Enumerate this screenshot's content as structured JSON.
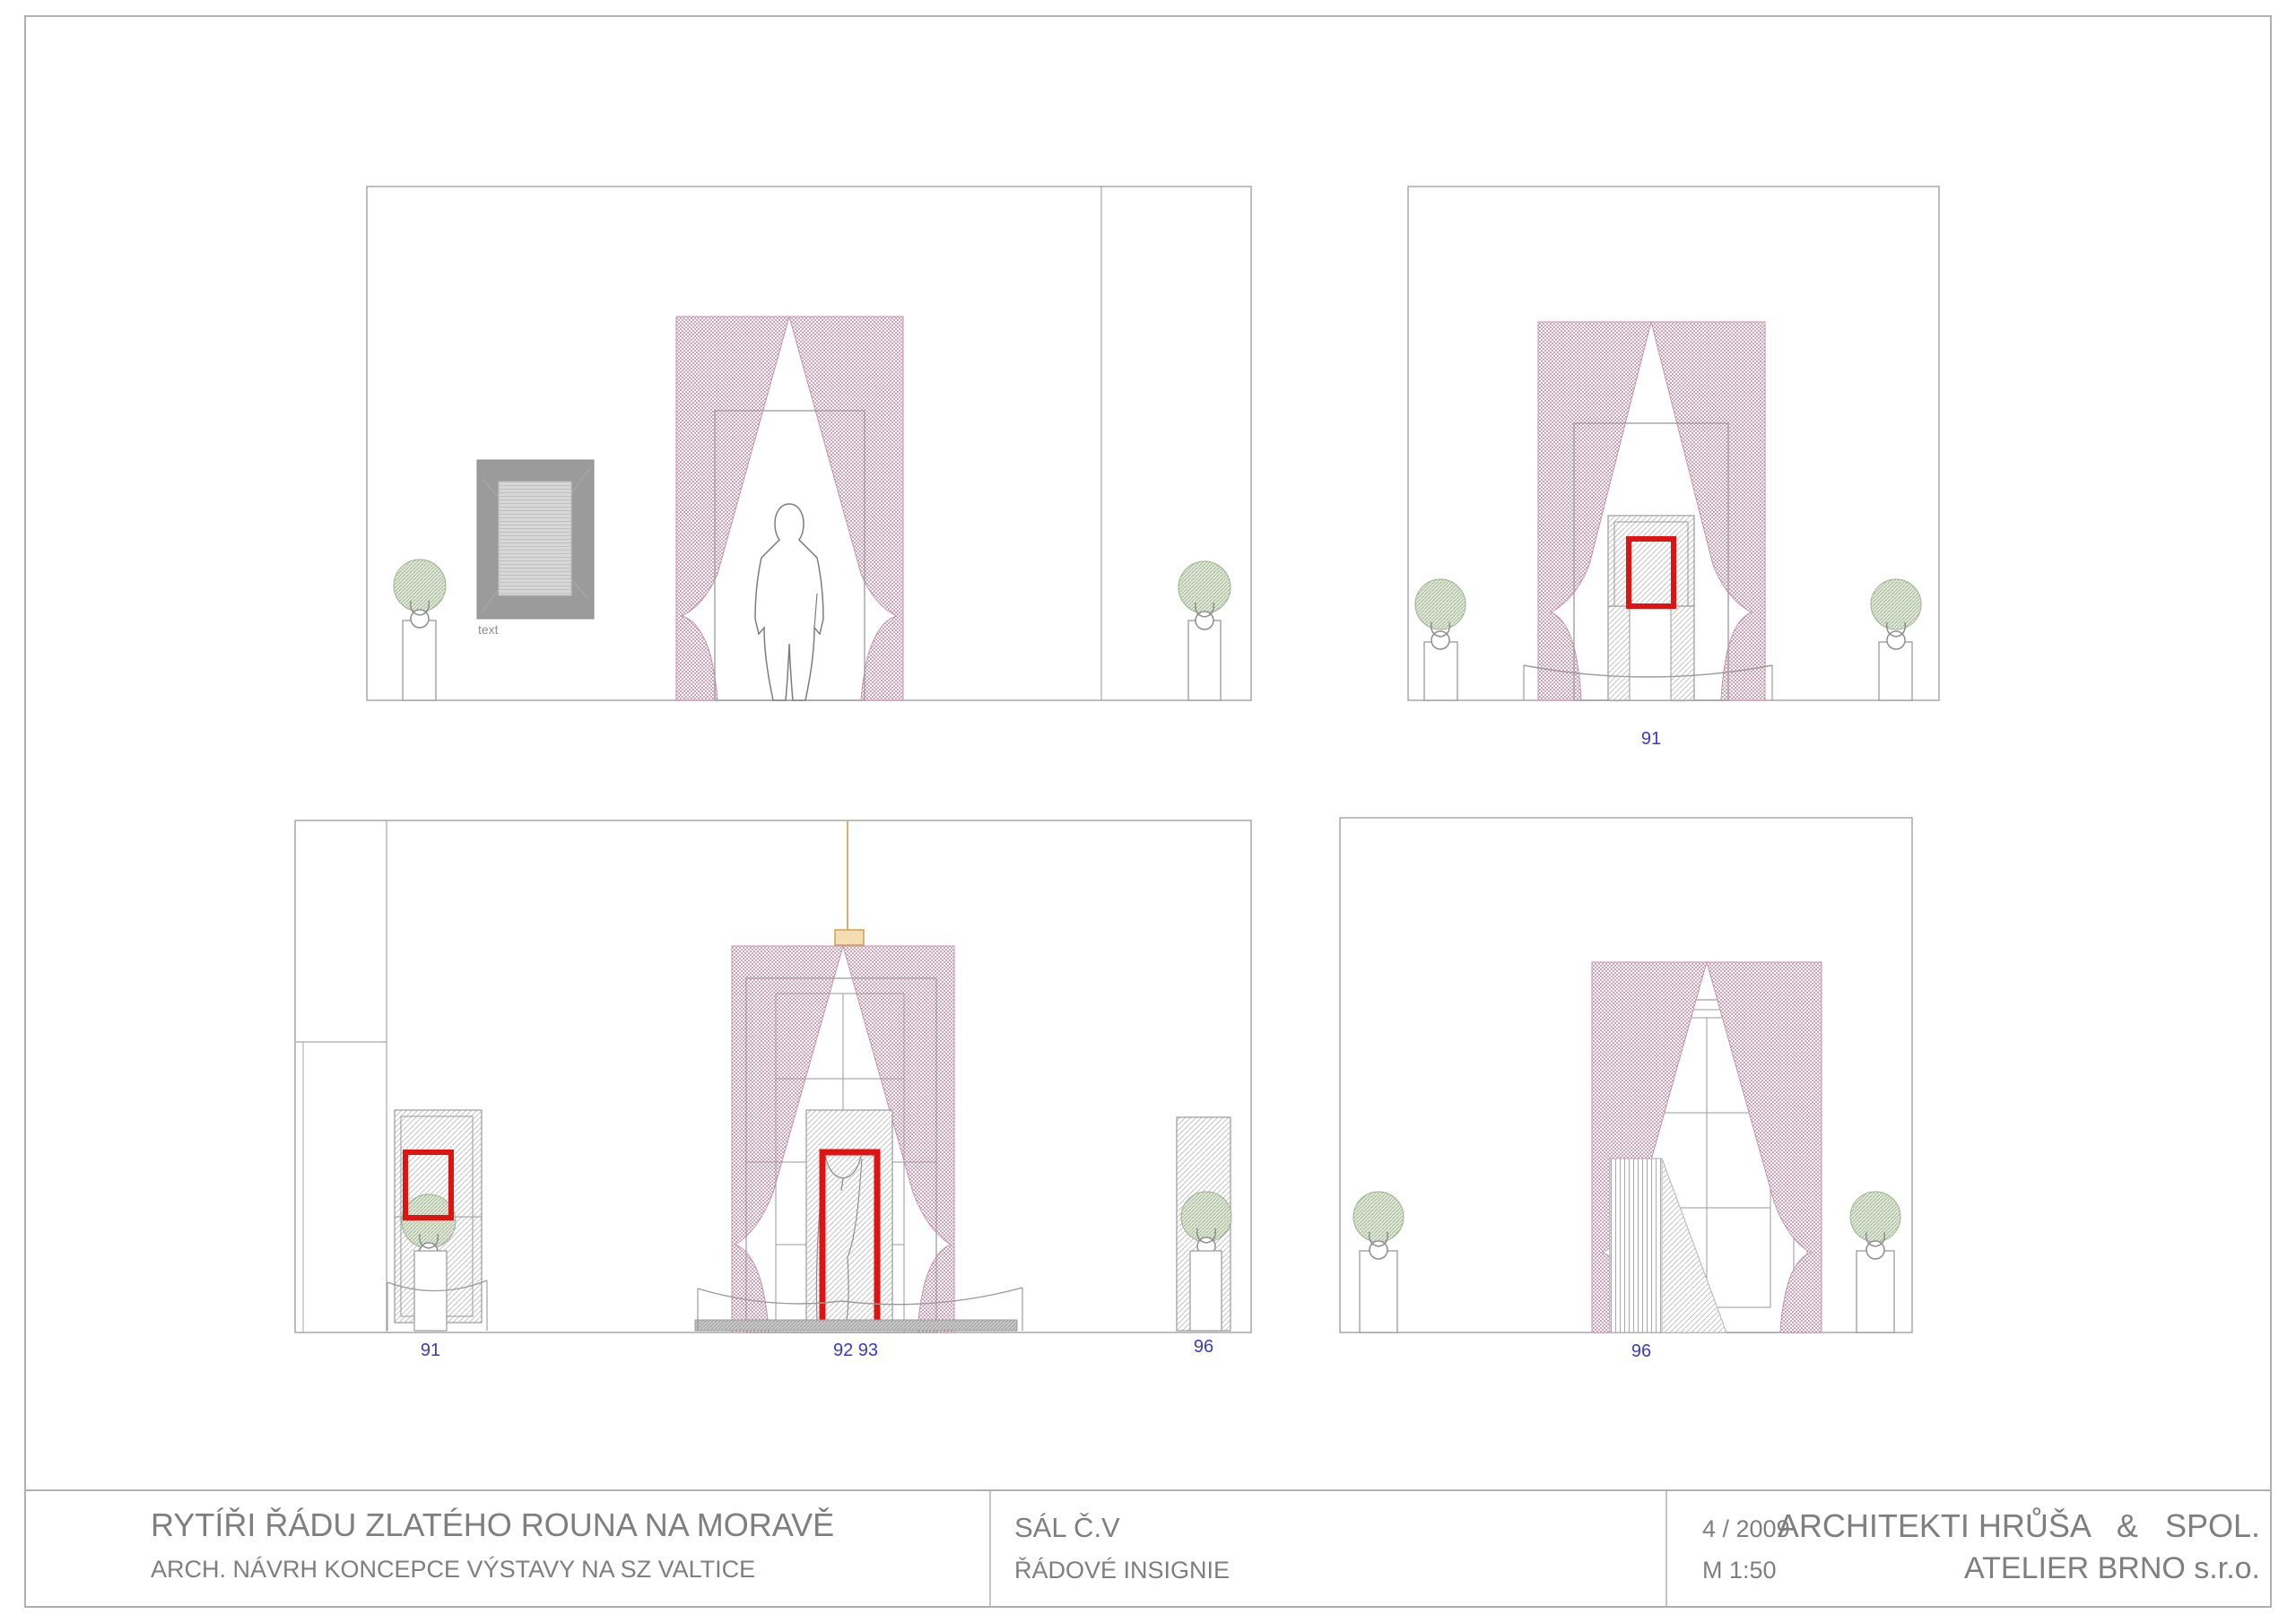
{
  "sheet": {
    "title_block": {
      "project_title": "RYTÍŘI ŘÁDU ZLATÉHO ROUNA NA MORAVĚ",
      "project_subtitle": "ARCH. NÁVRH KONCEPCE VÝSTAVY NA SZ VALTICE",
      "room": "SÁL Č.V",
      "content": "ŘÁDOVÉ INSIGNIE",
      "date": "4 / 2009",
      "scale": "M 1:50",
      "architects": "ARCHITEKTI HRŮŠA   &   SPOL.",
      "studio": "ATELIER BRNO s.r.o."
    },
    "labels": {
      "picture_caption": "text",
      "top_right_item": "91",
      "bottom_left_item_left": "91",
      "bottom_left_item_center": "92 93",
      "bottom_left_item_right": "96",
      "bottom_right_item": "96"
    },
    "colors": {
      "curtain_pink": "#d49eb3",
      "topiary_green_line": "#a6ba97",
      "topiary_green_fill": "#e0e8d7",
      "hatch_gray": "#c3c3c3",
      "line_gray": "#9a9a9a",
      "highlight_red": "#e01313",
      "label_blue": "#3a3ac6",
      "lamp_tan_fill": "#f3ddb2",
      "lamp_tan_line": "#cfa14e",
      "picture_frame_gray": "#9b9b9b",
      "plinth_gray": "#c8c8c8",
      "text_gray": "#7f7f7f"
    }
  }
}
